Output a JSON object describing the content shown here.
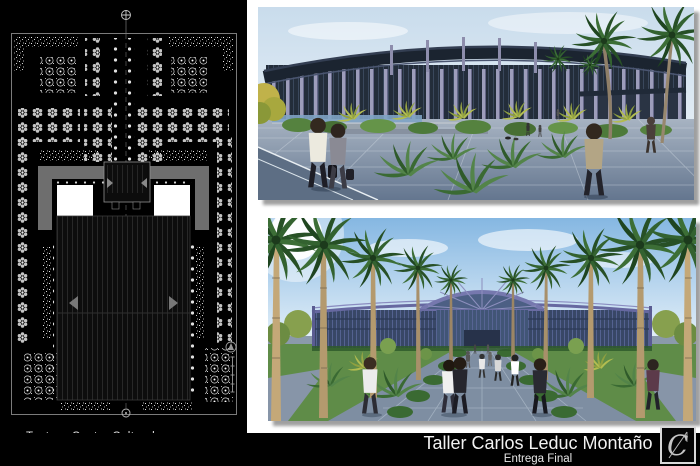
{
  "board": {
    "background": "#ffffff",
    "panel_background": "#000000"
  },
  "plan_panel": {
    "caption_title": "Teatro - Centro Cultural",
    "caption_author": "José Rafael dos Santos",
    "sheet_number": "6/6"
  },
  "renderings": {
    "top_name": "exterior-perspective-rendering",
    "bottom_name": "entrance-axis-rendering"
  },
  "footer": {
    "studio": "Taller Carlos Leduc Montaño",
    "phase": "Entrega Final",
    "logo_letter": "C"
  },
  "colors": {
    "structure_purple": "#8a8ab2",
    "glass_dark": "#2a3546",
    "sky_blue": "#8fbce0",
    "foliage_green": "#3c6e36",
    "drop_shadow": "#9f9f9f"
  }
}
